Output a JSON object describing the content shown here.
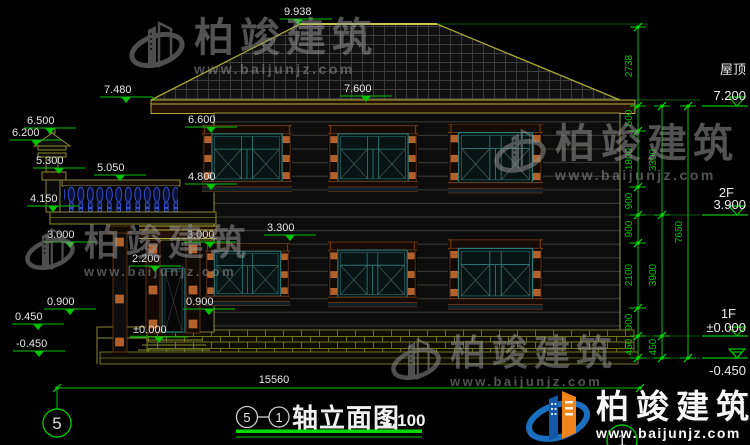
{
  "drawing": {
    "title": {
      "axis_from": "5",
      "axis_to": "1",
      "name": "轴立面图",
      "scale": "1:100"
    },
    "bottom": {
      "total_width": "15560",
      "axis_left": "5",
      "axis_right": "1"
    },
    "left_marks": [
      "9.938",
      "7.480",
      "7.600",
      "6.500",
      "6.200",
      "5.300",
      "5.050",
      "4.150",
      "6.600",
      "4.800",
      "3.300",
      "3.000",
      "3.000",
      "2.200",
      "0.900",
      "0.900",
      "0.450",
      "±0.000",
      "-0.450"
    ],
    "right_levels": [
      {
        "name": "屋顶",
        "value": "7.200"
      },
      {
        "name": "2F",
        "value": "3.900"
      },
      {
        "name": "1F",
        "value": "±0.000"
      },
      {
        "name": "",
        "value": "-0.450"
      }
    ],
    "right_chain": {
      "col1": [
        "2738",
        "600",
        "1800",
        "900",
        "900",
        "2100",
        "900",
        "450"
      ],
      "col2": [
        "3300",
        "3900",
        "450"
      ],
      "col3": [
        "7650"
      ]
    }
  },
  "watermark": {
    "brand": "柏竣建筑",
    "url": "www.baijunjz.com"
  },
  "icons": {
    "brand_logo": "building-swoosh-logo"
  },
  "colors": {
    "background": "#000000",
    "dim_green": "#00c300",
    "bright_green": "#00e000",
    "text_white": "#e6e6e6",
    "roof_edge": "#a8a832",
    "cornice_brown": "#241005",
    "frame_brown": "#6b3a16",
    "corbel_orange": "#b5651d",
    "glass_teal": "#2e7d7d",
    "baluster_blue": "#3550c8",
    "brick_line": "#74741e",
    "logo_blue": "#1b6fc0",
    "logo_orange": "#f0841a"
  }
}
